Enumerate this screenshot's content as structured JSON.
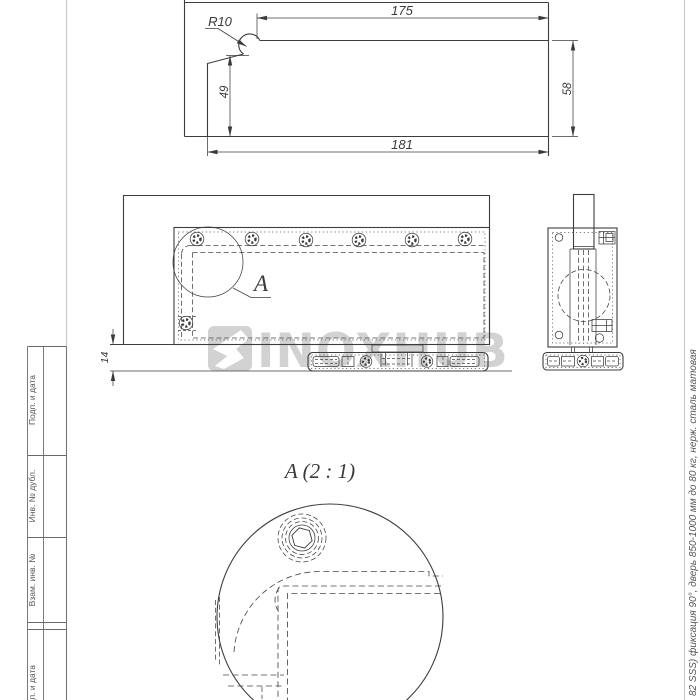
{
  "top_view": {
    "dim_top_width": "175",
    "dim_bottom_width": "181",
    "dim_left_height": "49",
    "dim_right_height": "58",
    "corner_radius_label": "R10"
  },
  "front_view": {
    "dim_floor_gap": "14",
    "detail_callout": "A"
  },
  "detail_view": {
    "title": "A (2 : 1)"
  },
  "watermark": {
    "text": "INOXHUB"
  },
  "title_block": {
    "labels": [
      "Подп. и дата",
      "Инв. № дубл.",
      "Взам. инв. №",
      "Подп. и дата"
    ]
  },
  "side_note": {
    "text": "82 SSS) фиксация 90°, дверь 850-1000 мм до 80 кг, нерж. сталь матовая"
  },
  "colors": {
    "linework": "#3d3d3d",
    "frame": "#cbcbcb",
    "watermark": "#d2d2d2"
  }
}
